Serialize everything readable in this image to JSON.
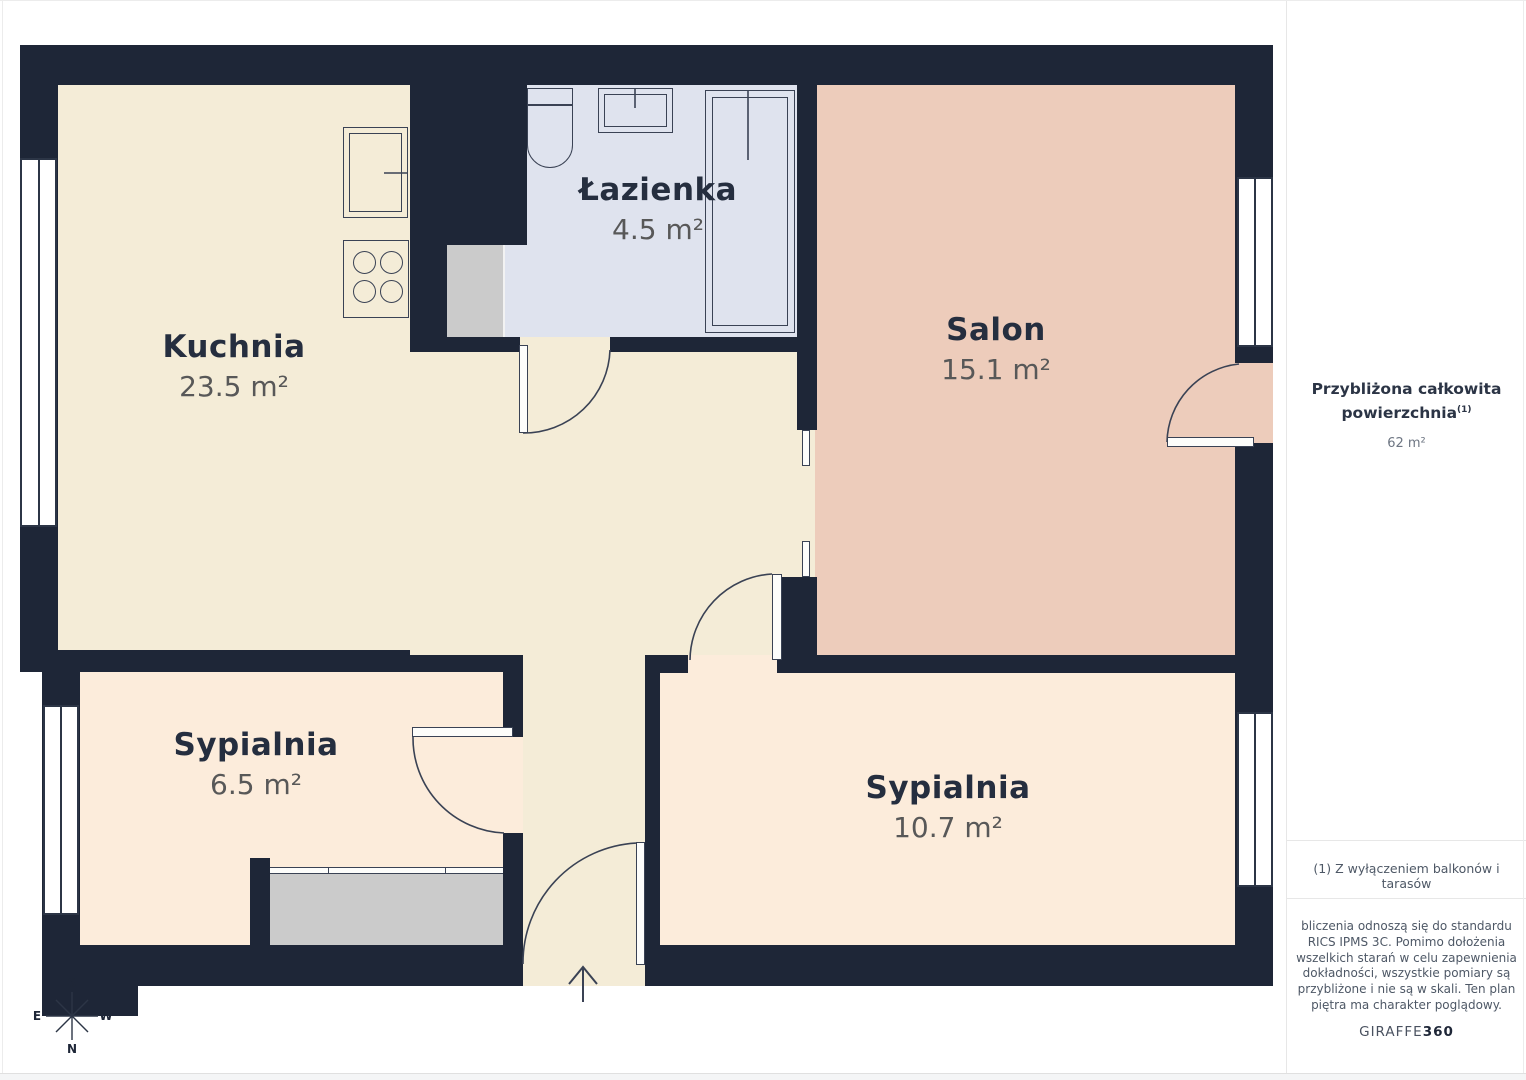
{
  "plan": {
    "rooms": [
      {
        "name": "Kuchnia",
        "area": "23.5 m²"
      },
      {
        "name": "Łazienka",
        "area": "4.5 m²"
      },
      {
        "name": "Salon",
        "area": "15.1 m²"
      },
      {
        "name": "Sypialnia",
        "area": "6.5 m²"
      },
      {
        "name": "Sypialnia",
        "area": "10.7 m²"
      }
    ],
    "compass": {
      "n": "N",
      "s": "S",
      "e": "E",
      "w": "W"
    }
  },
  "sidebar": {
    "total_line1": "Przybliżona całkowita",
    "total_line2": "powierzchnia",
    "total_sup": "(1)",
    "total_value": "62 m²",
    "footnote": "(1) Z wyłączeniem balkonów i tarasów",
    "disclaimer_lines": [
      "bliczenia odnoszą się do standardu",
      "RICS IPMS 3C. Pomimo dołożenia",
      "wszelkich starań w celu zapewnienia",
      "dokładności, wszystkie pomiary są",
      "przybliżone i nie są w skali. Ten plan",
      "piętra ma charakter poglądowy."
    ],
    "brand_prefix": "GIRAFFE",
    "brand_suffix": "360"
  },
  "colors": {
    "wall": "#1e2637",
    "kitchen_hall_floor": "#f4ecd7",
    "bedroom_floor": "#fcecdb",
    "salon_floor": "#edccbb",
    "bathroom_floor": "#dfe3ee",
    "furniture_gray": "#cbcbcb",
    "line": "#3a4254"
  }
}
